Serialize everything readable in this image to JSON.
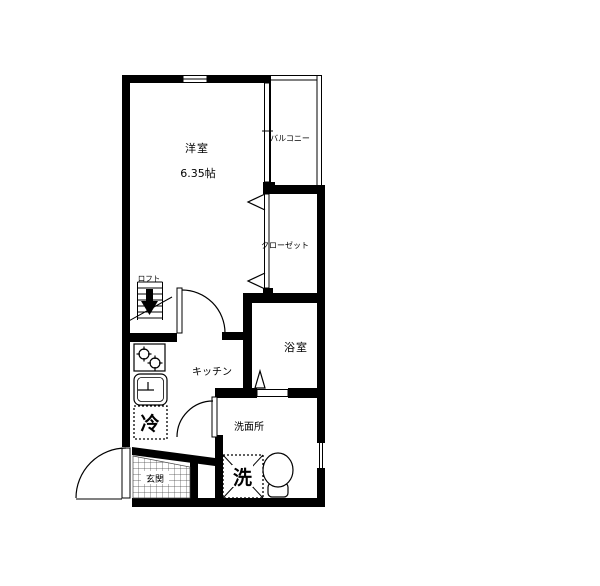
{
  "floorplan": {
    "rooms": {
      "western_room": {
        "label": "洋室",
        "size_label": "6.35帖"
      },
      "balcony": {
        "label": "バルコニー"
      },
      "closet": {
        "label": "クローゼット"
      },
      "bathroom": {
        "label": "浴室"
      },
      "kitchen": {
        "label": "キッチン"
      },
      "washroom": {
        "label": "洗面所"
      },
      "entrance": {
        "label": "玄関"
      },
      "loft": {
        "label": "ロフト"
      }
    },
    "fixtures": {
      "refrigerator": {
        "label": "冷"
      },
      "washing_machine": {
        "label": "洗"
      }
    },
    "colors": {
      "wall": "#000000",
      "background": "#ffffff"
    }
  }
}
